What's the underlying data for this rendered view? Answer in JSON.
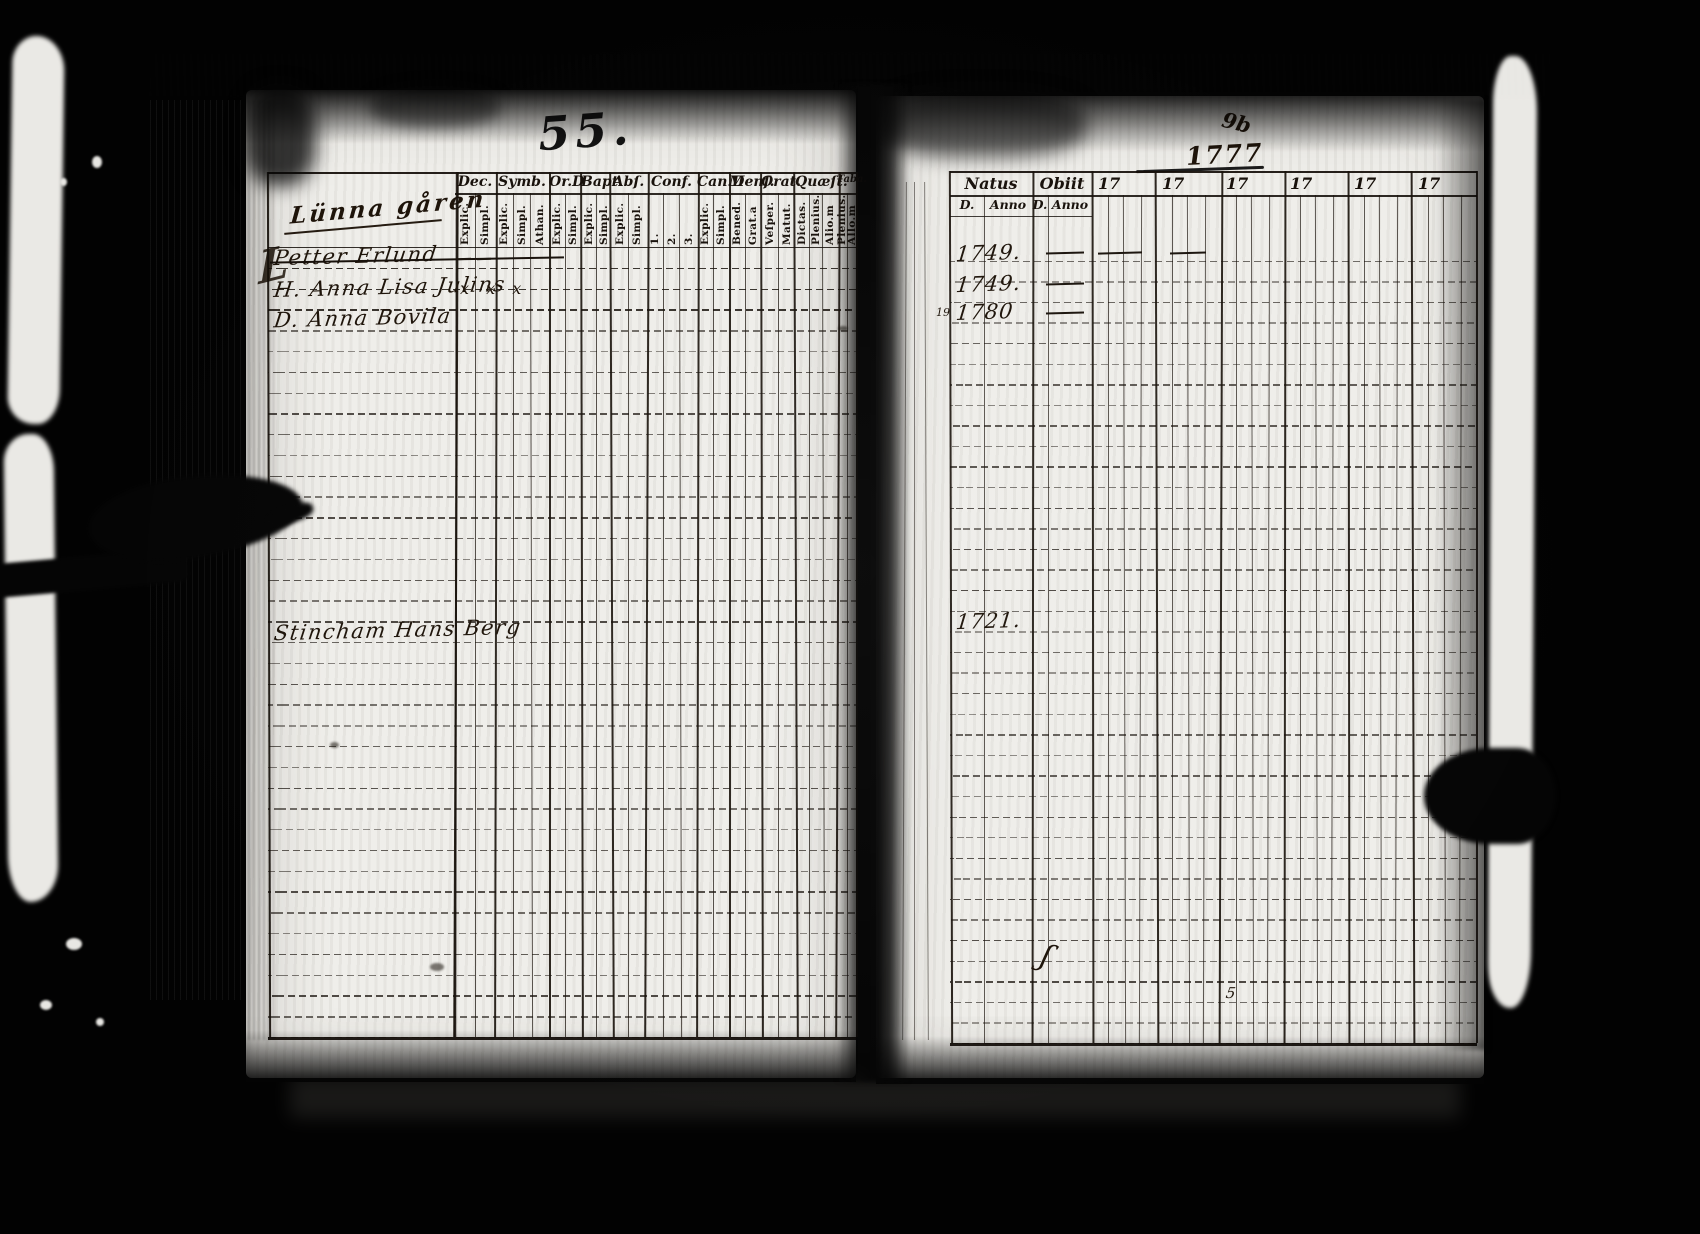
{
  "scan": {
    "left_page_number": "55.",
    "right_page_note_top": "9b",
    "right_page_note_year": "1777",
    "ink_color": "#17100a",
    "page_color": "#efeeea"
  },
  "left_table": {
    "script_title": "Lünna gåren",
    "flourish_glyph": "L",
    "groups": [
      {
        "label": "Dec.",
        "subs": [
          "Explic.",
          "Simpl."
        ]
      },
      {
        "label": "Symb.",
        "subs": [
          "Explic.",
          "Simpl.",
          "Athan."
        ]
      },
      {
        "label": "Or.D",
        "subs": [
          "Explic.",
          "Simpl."
        ]
      },
      {
        "label": "Bapt.",
        "subs": [
          "Explic.",
          "Simpl."
        ]
      },
      {
        "label": "Abſ.",
        "subs": [
          "Explic.",
          "Simpl."
        ]
      },
      {
        "label": "Conf.",
        "subs": [
          "1.",
          "2.",
          "3."
        ]
      },
      {
        "label": "Can.D",
        "subs": [
          "Explic.",
          "Simpl."
        ]
      },
      {
        "label": "Menſ.",
        "subs": [
          "Bened.",
          "Grat.a"
        ]
      },
      {
        "label": "Orat.",
        "subs": [
          "Veſper.",
          "Matut."
        ]
      },
      {
        "label": "Quæſt.",
        "subs": [
          "Dictas.",
          "Plenius.",
          "Alio.m"
        ]
      },
      {
        "label": "Taba.",
        "subs": [
          "Plenius.",
          "Allo.m"
        ]
      }
    ],
    "entries": [
      {
        "row": 1,
        "text": "Petter Erlund",
        "struck": true
      },
      {
        "row": 2.5,
        "text": "H. Anna Lisa Julins",
        "marks": "x x x"
      },
      {
        "row": 4,
        "text": "D. Anna Bovila"
      },
      {
        "row": 19,
        "text": "Stincham Hans Berg"
      }
    ],
    "pen_dashes": [
      {
        "r": 0.55,
        "x": 457,
        "w": 14
      },
      {
        "r": 0.55,
        "x": 477,
        "w": 14
      }
    ],
    "row_count": 38
  },
  "right_table": {
    "groups": [
      {
        "label": "Natus",
        "subs": [
          "D.",
          "Anno"
        ]
      },
      {
        "label": "Obiit",
        "subs": [
          "D.",
          "Anno"
        ]
      },
      {
        "label": "17",
        "subs": [
          "",
          "",
          "",
          ""
        ]
      },
      {
        "label": "17",
        "subs": [
          "",
          "",
          "",
          ""
        ]
      },
      {
        "label": "17",
        "subs": [
          "",
          "",
          "",
          ""
        ]
      },
      {
        "label": "17",
        "subs": [
          "",
          "",
          "",
          ""
        ]
      },
      {
        "label": "17",
        "subs": [
          "",
          "",
          "",
          ""
        ]
      },
      {
        "label": "17",
        "subs": [
          "",
          "",
          "",
          ""
        ]
      }
    ],
    "entries": [
      {
        "row": 1.2,
        "text": "1749."
      },
      {
        "row": 2.7,
        "text": "1749."
      },
      {
        "row": 4.1,
        "text": "1780",
        "pre": "19"
      },
      {
        "row": 19.1,
        "text": "1721."
      },
      {
        "row": 35.1,
        "text": "ʃ",
        "x": 1042,
        "size": 30,
        "rot": 14
      },
      {
        "row": 37.3,
        "text": "5",
        "x": 1226,
        "size": 15,
        "rot": 0
      }
    ],
    "pen_dashes": [
      {
        "r": 0.6,
        "x": 1046,
        "w": 38
      },
      {
        "r": 0.6,
        "x": 1098,
        "w": 44
      },
      {
        "r": 0.6,
        "x": 1170,
        "w": 36
      },
      {
        "r": 2.1,
        "x": 1046,
        "w": 38
      },
      {
        "r": 3.5,
        "x": 1046,
        "w": 38
      }
    ],
    "row_count": 39
  }
}
